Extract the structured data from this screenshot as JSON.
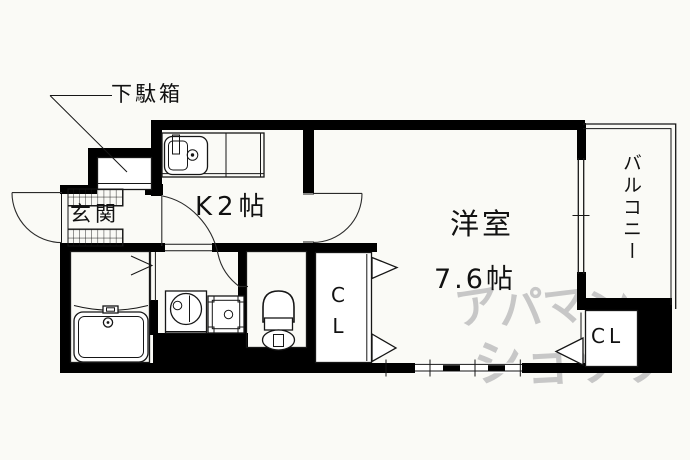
{
  "plan": {
    "labels": {
      "shoe_cabinet": "下駄箱",
      "entrance": "玄関",
      "kitchen": "K2帖",
      "main_room_name": "洋室",
      "main_room_size": "7.6帖",
      "closet_middle": "CL",
      "closet_right": "CL",
      "balcony": "バルコニー"
    },
    "watermark": {
      "line1": "アパマン",
      "line2": "ショップ"
    },
    "colors": {
      "wall": "#000000",
      "line": "#161616",
      "watermark": "#c7c7c7",
      "background": "#fafaf6"
    }
  }
}
